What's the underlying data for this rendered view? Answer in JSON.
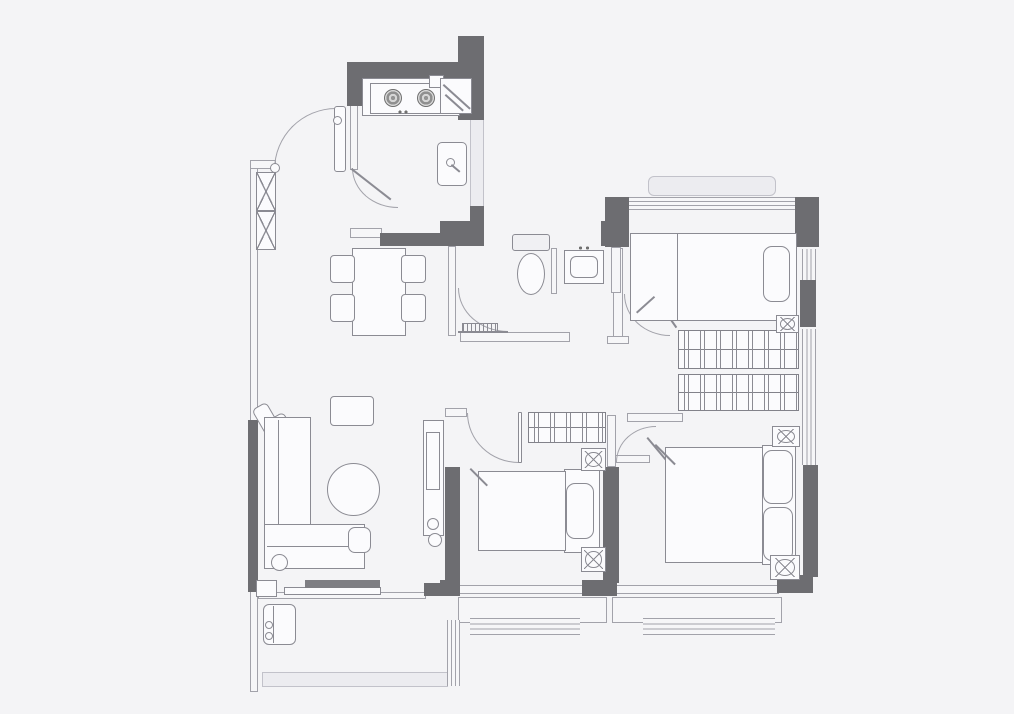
{
  "meta": {
    "kind": "apartment-floor-plan",
    "visible_text": []
  },
  "canvas": {
    "w": 1014,
    "h": 714,
    "background": "#f4f4f6"
  },
  "colors": {
    "w": "#fbfbfd",
    "f": "#ececf0",
    "g": "#7e7e83",
    "lg": "#f0f0f3"
  },
  "elements": [
    {
      "n": "kitchen-right-ledge",
      "t": "fill",
      "x": 470,
      "y": 118,
      "w": 14,
      "h": 90
    },
    {
      "n": "bay-window-ledge",
      "t": "fill",
      "x": 648,
      "y": 176,
      "w": 128,
      "h": 20,
      "r": 6
    },
    {
      "n": "balcony-bottom-band",
      "t": "fill",
      "x": 262,
      "y": 672,
      "w": 186,
      "h": 15
    },
    {
      "n": "left-wall",
      "t": "thin",
      "x": 250,
      "y": 160,
      "w": 8,
      "h": 532
    },
    {
      "n": "entry-wall-cap",
      "t": "thin",
      "x": 250,
      "y": 160,
      "w": 26,
      "h": 9
    },
    {
      "n": "kitchen-left-wall",
      "t": "thin",
      "x": 350,
      "y": 104,
      "w": 8,
      "h": 66
    },
    {
      "n": "kitchen-bottom-stub",
      "t": "thin",
      "x": 350,
      "y": 228,
      "w": 32,
      "h": 10
    },
    {
      "n": "bath-left-wall",
      "t": "thin",
      "x": 448,
      "y": 246,
      "w": 8,
      "h": 90
    },
    {
      "n": "bath-bottom-wall",
      "t": "thin",
      "x": 460,
      "y": 332,
      "w": 110,
      "h": 10
    },
    {
      "n": "bath-partition-wall",
      "t": "thin",
      "x": 551,
      "y": 248,
      "w": 6,
      "h": 46
    },
    {
      "n": "corridor-wall",
      "t": "thin",
      "x": 613,
      "y": 248,
      "w": 10,
      "h": 92
    },
    {
      "n": "corridor-wall-foot",
      "t": "thin",
      "x": 607,
      "y": 336,
      "w": 22,
      "h": 8
    },
    {
      "n": "bedroom1-left-lower-wall",
      "t": "thin",
      "x": 611,
      "y": 247,
      "w": 10,
      "h": 46
    },
    {
      "n": "bedroom2-top-wall-stub",
      "t": "thin",
      "x": 445,
      "y": 408,
      "w": 22,
      "h": 9
    },
    {
      "n": "bedroom2-right-upper-wall",
      "t": "thin",
      "x": 607,
      "y": 415,
      "w": 9,
      "h": 52
    },
    {
      "n": "bedroom1-bottom-wall",
      "t": "thin",
      "x": 627,
      "y": 413,
      "w": 56,
      "h": 9
    },
    {
      "n": "master-top-wall-stub",
      "t": "thin",
      "x": 615,
      "y": 455,
      "w": 35,
      "h": 8
    },
    {
      "n": "living-balcony-wall",
      "t": "thin",
      "x": 258,
      "y": 592,
      "w": 168,
      "h": 7
    },
    {
      "n": "bedroom2-bottom-wall",
      "t": "thin",
      "x": 458,
      "y": 585,
      "w": 126,
      "h": 9
    },
    {
      "n": "master-bottom-wall",
      "t": "thin",
      "x": 615,
      "y": 585,
      "w": 164,
      "h": 9
    },
    {
      "n": "sill-box-bedroom2",
      "t": "thin",
      "x": 458,
      "y": 597,
      "w": 149,
      "h": 26
    },
    {
      "n": "sill-box-master",
      "t": "thin",
      "x": 612,
      "y": 597,
      "w": 170,
      "h": 26
    },
    {
      "n": "bedroom1-top-window",
      "t": "winh",
      "x": 629,
      "y": 197,
      "w": 166,
      "h": 13
    },
    {
      "n": "bedroom1-right-window",
      "t": "winv",
      "x": 802,
      "y": 249,
      "w": 14,
      "h": 31
    },
    {
      "n": "master-right-window",
      "t": "winv",
      "x": 802,
      "y": 329,
      "w": 14,
      "h": 136
    },
    {
      "n": "bedroom2-bottom-window",
      "t": "winh",
      "x": 470,
      "y": 618,
      "w": 110,
      "h": 17
    },
    {
      "n": "master-bottom-window",
      "t": "winh",
      "x": 643,
      "y": 618,
      "w": 132,
      "h": 17
    },
    {
      "n": "balcony-right-window",
      "t": "winv",
      "x": 447,
      "y": 620,
      "w": 13,
      "h": 66
    },
    {
      "n": "kitchen-top-wall",
      "t": "wall",
      "x": 347,
      "y": 62,
      "w": 112,
      "h": 16
    },
    {
      "n": "kitchen-topleft-stub",
      "t": "wall",
      "x": 347,
      "y": 62,
      "w": 16,
      "h": 44
    },
    {
      "n": "kitchen-right-column",
      "t": "wall",
      "x": 458,
      "y": 36,
      "w": 26,
      "h": 84
    },
    {
      "n": "kitchen-right-mid-wall",
      "t": "wall",
      "x": 470,
      "y": 206,
      "w": 14,
      "h": 40
    },
    {
      "n": "hallway-wall-bar",
      "t": "wall",
      "x": 380,
      "y": 233,
      "w": 104,
      "h": 13
    },
    {
      "n": "hallway-wall-bar-thick",
      "t": "wall",
      "x": 440,
      "y": 221,
      "w": 44,
      "h": 25
    },
    {
      "n": "bath-topright-stub",
      "t": "wall",
      "x": 601,
      "y": 221,
      "w": 16,
      "h": 25
    },
    {
      "n": "bedroom1-topleft-wall",
      "t": "wall",
      "x": 605,
      "y": 197,
      "w": 24,
      "h": 50
    },
    {
      "n": "bedroom1-topright-wall",
      "t": "wall",
      "x": 795,
      "y": 197,
      "w": 24,
      "h": 50
    },
    {
      "n": "right-wall-upper",
      "t": "wall",
      "x": 800,
      "y": 280,
      "w": 16,
      "h": 47
    },
    {
      "n": "right-wall-lower",
      "t": "wall",
      "x": 803,
      "y": 465,
      "w": 15,
      "h": 112
    },
    {
      "n": "plan-bottomright-corner",
      "t": "wall",
      "x": 777,
      "y": 575,
      "w": 36,
      "h": 18
    },
    {
      "n": "master-bottomleft-corner",
      "t": "wall",
      "x": 582,
      "y": 580,
      "w": 35,
      "h": 16
    },
    {
      "n": "bedroom2-bottomleft-corner",
      "t": "wall",
      "x": 440,
      "y": 580,
      "w": 20,
      "h": 16
    },
    {
      "n": "bedroom2-left-wall",
      "t": "wall",
      "x": 445,
      "y": 467,
      "w": 15,
      "h": 126
    },
    {
      "n": "bedroom2-right-wall",
      "t": "wall",
      "x": 603,
      "y": 467,
      "w": 16,
      "h": 116
    },
    {
      "n": "left-wall-segment",
      "t": "wall",
      "x": 248,
      "y": 420,
      "w": 10,
      "h": 172
    },
    {
      "n": "balcony-door-stub",
      "t": "wall",
      "x": 424,
      "y": 583,
      "w": 26,
      "h": 13
    },
    {
      "n": "entry-door-arc",
      "t": "arc tl",
      "x": 274,
      "y": 108,
      "w": 62,
      "h": 62
    },
    {
      "n": "entry-door-leaf",
      "t": "round",
      "x": 334,
      "y": 106,
      "w": 12,
      "h": 66,
      "r": 3
    },
    {
      "n": "entry-door-knob",
      "t": "circle",
      "x": 333,
      "y": 116,
      "w": 9,
      "h": 9
    },
    {
      "n": "kitchen-door-arc",
      "t": "arc bl",
      "x": 352,
      "y": 168,
      "w": 46,
      "h": 40
    },
    {
      "n": "kitchen-door-leaf",
      "t": "diag",
      "x": 352,
      "y": 168,
      "w": 50,
      "rot": 38
    },
    {
      "n": "bath-door-arc",
      "t": "arc bl",
      "x": 458,
      "y": 288,
      "w": 50,
      "h": 44
    },
    {
      "n": "bath-door-leaf",
      "t": "hline",
      "x": 458,
      "y": 331,
      "w": 50,
      "h": 2
    },
    {
      "n": "bedroom2-door-arc",
      "t": "arc bl",
      "x": 467,
      "y": 413,
      "w": 52,
      "h": 50
    },
    {
      "n": "bedroom2-door-leaf",
      "t": "round",
      "x": 518,
      "y": 412,
      "w": 4,
      "h": 51,
      "r": 1
    },
    {
      "n": "bedroom1-door-arc",
      "t": "arc bl",
      "x": 624,
      "y": 294,
      "w": 46,
      "h": 42
    },
    {
      "n": "bedroom1-door-leaf",
      "t": "diag",
      "x": 652,
      "y": 291,
      "w": 44,
      "rot": 55
    },
    {
      "n": "master-door-arc",
      "t": "arc tl",
      "x": 616,
      "y": 426,
      "w": 40,
      "h": 36
    },
    {
      "n": "master-door-leaf",
      "t": "diag",
      "x": 648,
      "y": 437,
      "w": 38,
      "rot": 50
    },
    {
      "n": "kitchen-counter",
      "t": "box",
      "x": 362,
      "y": 78,
      "w": 98,
      "h": 38,
      "bg": "w"
    },
    {
      "n": "kitchen-stove",
      "t": "box",
      "x": 370,
      "y": 83,
      "w": 76,
      "h": 31,
      "bg": "w"
    },
    {
      "n": "stove-burner-left",
      "t": "burner",
      "x": 384,
      "y": 89,
      "w": 18,
      "h": 18
    },
    {
      "n": "stove-burner-right",
      "t": "burner",
      "x": 417,
      "y": 89,
      "w": 18,
      "h": 18
    },
    {
      "n": "stove-knobs",
      "t": "dots",
      "x": 396,
      "y": 109,
      "w": 14,
      "h": 6
    },
    {
      "n": "counter-small-box",
      "t": "box",
      "x": 429,
      "y": 75,
      "w": 15,
      "h": 13,
      "bg": "w"
    },
    {
      "n": "counter-corner-unit",
      "t": "box",
      "x": 440,
      "y": 78,
      "w": 32,
      "h": 36,
      "bg": "w"
    },
    {
      "n": "corner-unit-edge-a",
      "t": "diag",
      "x": 444,
      "y": 84,
      "w": 36,
      "rot": 42
    },
    {
      "n": "corner-unit-edge-b",
      "t": "diag",
      "x": 446,
      "y": 94,
      "w": 24,
      "rot": 42
    },
    {
      "n": "kitchen-sink",
      "t": "round",
      "x": 437,
      "y": 142,
      "w": 30,
      "h": 44,
      "r": 5
    },
    {
      "n": "sink-faucet",
      "t": "circle",
      "x": 446,
      "y": 158,
      "w": 9,
      "h": 9
    },
    {
      "n": "sink-faucet-lever",
      "t": "diag",
      "x": 452,
      "y": 164,
      "w": 11,
      "rot": 40
    },
    {
      "n": "shoe-cabinet-upper",
      "t": "xbox",
      "x": 256,
      "y": 172,
      "w": 20,
      "h": 39
    },
    {
      "n": "shoe-cabinet-lower",
      "t": "xbox",
      "x": 256,
      "y": 211,
      "w": 20,
      "h": 39
    },
    {
      "n": "shoe-cabinet-knob",
      "t": "circle",
      "x": 270,
      "y": 163,
      "w": 10,
      "h": 10
    },
    {
      "n": "dining-table",
      "t": "box",
      "x": 352,
      "y": 248,
      "w": 54,
      "h": 88,
      "bg": "w"
    },
    {
      "n": "dining-chair-nw",
      "t": "chair",
      "x": 330,
      "y": 255,
      "w": 25,
      "h": 28
    },
    {
      "n": "dining-chair-ne",
      "t": "chair",
      "x": 401,
      "y": 255,
      "w": 25,
      "h": 28
    },
    {
      "n": "dining-chair-sw",
      "t": "chair",
      "x": 330,
      "y": 294,
      "w": 25,
      "h": 28
    },
    {
      "n": "dining-chair-se",
      "t": "chair",
      "x": 401,
      "y": 294,
      "w": 25,
      "h": 28
    },
    {
      "n": "toilet-tank",
      "t": "round",
      "x": 512,
      "y": 234,
      "w": 38,
      "h": 17,
      "r": 3,
      "bg": "lg"
    },
    {
      "n": "toilet-bowl",
      "t": "ellipse",
      "x": 517,
      "y": 253,
      "w": 28,
      "h": 42
    },
    {
      "n": "bath-vanity",
      "t": "box",
      "x": 564,
      "y": 250,
      "w": 40,
      "h": 34,
      "bg": "w"
    },
    {
      "n": "bath-basin",
      "t": "round",
      "x": 570,
      "y": 256,
      "w": 28,
      "h": 22,
      "r": 6
    },
    {
      "n": "bath-faucet-marks",
      "t": "dots",
      "x": 576,
      "y": 245,
      "w": 16,
      "h": 6
    },
    {
      "n": "shower-drain",
      "t": "grill",
      "x": 462,
      "y": 323,
      "w": 36,
      "h": 10
    },
    {
      "n": "bedroom1-bed",
      "t": "box",
      "x": 630,
      "y": 233,
      "w": 167,
      "h": 88,
      "bg": "w"
    },
    {
      "n": "bedroom1-bed-line",
      "t": "vline",
      "x": 677,
      "y": 234,
      "w": 1,
      "h": 86
    },
    {
      "n": "bedroom1-pillow",
      "t": "round",
      "x": 763,
      "y": 246,
      "w": 27,
      "h": 56,
      "r": 9
    },
    {
      "n": "bedroom1-blanket-fold",
      "t": "diag",
      "x": 636,
      "y": 312,
      "w": 24,
      "rot": -42
    },
    {
      "n": "bedroom1-wardrobe-a",
      "t": "wardrobe",
      "x": 678,
      "y": 330,
      "w": 121,
      "h": 39
    },
    {
      "n": "bedroom1-wardrobe-b",
      "t": "wardrobe",
      "x": 678,
      "y": 374,
      "w": 121,
      "h": 37
    },
    {
      "n": "bedroom1-lamp",
      "t": "fan",
      "x": 776,
      "y": 315,
      "w": 23,
      "h": 18
    },
    {
      "n": "master-headboard",
      "t": "box",
      "x": 762,
      "y": 445,
      "w": 34,
      "h": 120,
      "bg": "w"
    },
    {
      "n": "master-bed",
      "t": "box",
      "x": 665,
      "y": 447,
      "w": 98,
      "h": 116,
      "bg": "w"
    },
    {
      "n": "master-pillow-top",
      "t": "round",
      "x": 763,
      "y": 450,
      "w": 30,
      "h": 54,
      "r": 9
    },
    {
      "n": "master-pillow-bottom",
      "t": "round",
      "x": 763,
      "y": 507,
      "w": 30,
      "h": 54,
      "r": 9
    },
    {
      "n": "master-blanket-fold",
      "t": "diag",
      "x": 656,
      "y": 444,
      "w": 28,
      "rot": 45
    },
    {
      "n": "master-nightstand-lamp-top",
      "t": "fan",
      "x": 772,
      "y": 426,
      "w": 28,
      "h": 21
    },
    {
      "n": "master-nightstand-lamp-bottom",
      "t": "fan",
      "x": 770,
      "y": 555,
      "w": 30,
      "h": 25
    },
    {
      "n": "bedroom2-wardrobe",
      "t": "wardrobe",
      "x": 528,
      "y": 412,
      "w": 78,
      "h": 31
    },
    {
      "n": "bedroom2-headboard",
      "t": "box",
      "x": 564,
      "y": 469,
      "w": 36,
      "h": 84,
      "bg": "w"
    },
    {
      "n": "bedroom2-bed",
      "t": "box",
      "x": 478,
      "y": 471,
      "w": 88,
      "h": 80,
      "bg": "w"
    },
    {
      "n": "bedroom2-pillow",
      "t": "round",
      "x": 566,
      "y": 483,
      "w": 28,
      "h": 56,
      "r": 9
    },
    {
      "n": "bedroom2-blanket-fold",
      "t": "diag",
      "x": 471,
      "y": 468,
      "w": 24,
      "rot": 45
    },
    {
      "n": "bedroom2-lamp-top",
      "t": "fan",
      "x": 581,
      "y": 448,
      "w": 25,
      "h": 23
    },
    {
      "n": "bedroom2-lamp-bottom",
      "t": "fan",
      "x": 581,
      "y": 547,
      "w": 25,
      "h": 25
    },
    {
      "n": "armchair-cushion-a",
      "t": "round",
      "x": 261,
      "y": 403,
      "w": 17,
      "h": 43,
      "r": 5,
      "rot": -30
    },
    {
      "n": "armchair-cushion-b",
      "t": "round",
      "x": 278,
      "y": 413,
      "w": 17,
      "h": 43,
      "r": 5,
      "rot": -30
    },
    {
      "n": "sofa-body",
      "t": "box",
      "x": 264,
      "y": 417,
      "w": 47,
      "h": 112,
      "bg": "w"
    },
    {
      "n": "sofa-seat-line",
      "t": "vline",
      "x": 278,
      "y": 420,
      "w": 1,
      "h": 107
    },
    {
      "n": "sofa-chaise",
      "t": "box",
      "x": 264,
      "y": 524,
      "w": 101,
      "h": 45,
      "bg": "w"
    },
    {
      "n": "sofa-chaise-line",
      "t": "hline",
      "x": 267,
      "y": 546,
      "w": 95,
      "h": 1
    },
    {
      "n": "sofa-round-cushion",
      "t": "circle",
      "x": 271,
      "y": 554,
      "w": 17,
      "h": 17
    },
    {
      "n": "side-table",
      "t": "round",
      "x": 348,
      "y": 527,
      "w": 23,
      "h": 26,
      "r": 7
    },
    {
      "n": "coffee-table",
      "t": "circle",
      "x": 327,
      "y": 463,
      "w": 53,
      "h": 53
    },
    {
      "n": "living-rug",
      "t": "round",
      "x": 330,
      "y": 396,
      "w": 44,
      "h": 30,
      "r": 4
    },
    {
      "n": "tv-board",
      "t": "box",
      "x": 284,
      "y": 587,
      "w": 97,
      "h": 8,
      "bg": "w"
    },
    {
      "n": "tv-unit",
      "t": "bar",
      "x": 305,
      "y": 580,
      "w": 75,
      "h": 8
    },
    {
      "n": "wall-end-box",
      "t": "box",
      "x": 256,
      "y": 580,
      "w": 21,
      "h": 17,
      "bg": "w"
    },
    {
      "n": "desk",
      "t": "box",
      "x": 423,
      "y": 420,
      "w": 21,
      "h": 116,
      "bg": "w"
    },
    {
      "n": "desk-monitor",
      "t": "box",
      "x": 426,
      "y": 432,
      "w": 14,
      "h": 58
    },
    {
      "n": "desk-item-small",
      "t": "circle",
      "x": 427,
      "y": 518,
      "w": 12,
      "h": 12
    },
    {
      "n": "desk-item-large",
      "t": "circle",
      "x": 428,
      "y": 533,
      "w": 14,
      "h": 14
    },
    {
      "n": "washing-machine",
      "t": "round",
      "x": 263,
      "y": 604,
      "w": 33,
      "h": 41,
      "r": 6
    },
    {
      "n": "washing-machine-knob-a",
      "t": "circle",
      "x": 265,
      "y": 621,
      "w": 8,
      "h": 8
    },
    {
      "n": "washing-machine-knob-b",
      "t": "circle",
      "x": 265,
      "y": 632,
      "w": 8,
      "h": 8
    },
    {
      "n": "washing-machine-door-line",
      "t": "vline",
      "x": 273,
      "y": 606,
      "w": 1,
      "h": 37
    }
  ]
}
